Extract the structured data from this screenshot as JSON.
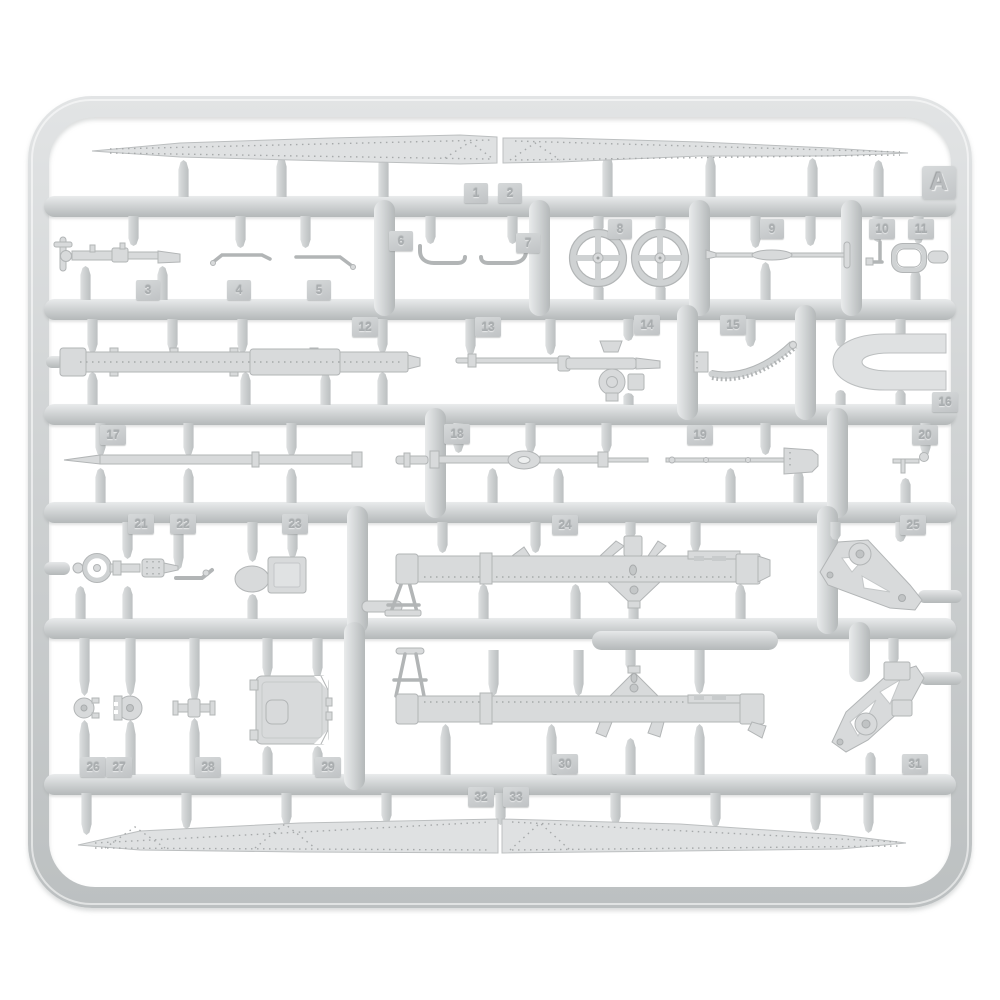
{
  "sprue": {
    "letter": "A",
    "part_numbers": [
      "1",
      "2",
      "3",
      "4",
      "5",
      "6",
      "7",
      "8",
      "9",
      "10",
      "11",
      "12",
      "13",
      "14",
      "15",
      "16",
      "17",
      "18",
      "19",
      "20",
      "21",
      "22",
      "23",
      "24",
      "25",
      "26",
      "27",
      "28",
      "29",
      "30",
      "31",
      "32",
      "33"
    ]
  },
  "colors": {
    "background": "#ffffff",
    "plastic_light": "#e9ebec",
    "plastic_mid": "#cfd2d3",
    "plastic_shadow": "#b4b8b9",
    "part_fill": "#d8dadb",
    "tag_face": "#c8cbcc",
    "emboss_text": "#a9adaf"
  }
}
